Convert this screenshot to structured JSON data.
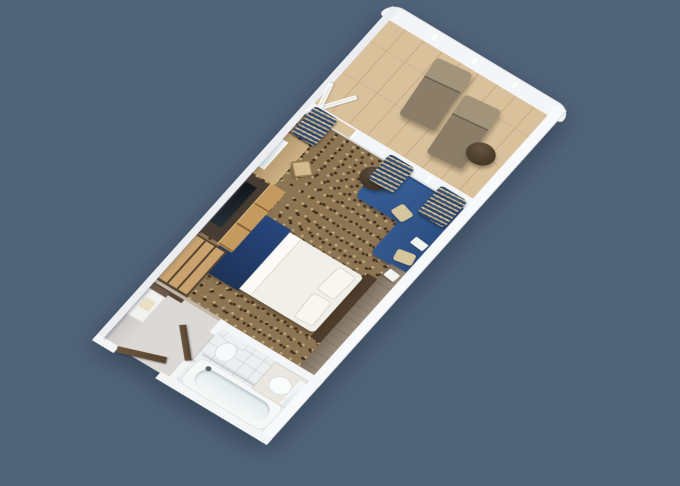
{
  "scene": {
    "type": "3d-floorplan-render",
    "title": "Cruise ship balcony stateroom - 3D floor plan",
    "view": "rotated top-down axonometric"
  },
  "theme": {
    "bg": "#51647a",
    "wall": "#f4f5f7",
    "carpet": "#8d7553",
    "balconyfloor": "#d9c19c",
    "hallfloor": "#dbd8d5",
    "bathfloor": "#eceff0",
    "glass": "#f2f6f8",
    "sofa": "#31598e",
    "cream": "#d6c69e"
  },
  "rooms": [
    {
      "name": "Balcony",
      "floor": "light wood planks",
      "furniture": [
        {
          "label": "Chaise lounge chair"
        },
        {
          "label": "Chaise lounge chair"
        },
        {
          "label": "Round outdoor table"
        },
        {
          "label": "Glass balustrade"
        },
        {
          "label": "Open sliding glass door"
        }
      ]
    },
    {
      "name": "Stateroom",
      "floor": "patterned brown carpet",
      "furniture": [
        {
          "label": "Bed with white duvet and navy runner"
        },
        {
          "label": "L-shaped navy sofa"
        },
        {
          "label": "Round coffee table"
        },
        {
          "label": "Wood ledge desk"
        },
        {
          "label": "Vanity desk with mirror"
        },
        {
          "label": "Desk chair"
        },
        {
          "label": "Flat-screen TV"
        },
        {
          "label": "TV console cabinet"
        },
        {
          "label": "Wardrobe closet"
        },
        {
          "label": "Navy and tan curtains"
        },
        {
          "label": "Dark wood headboard"
        },
        {
          "label": "Floor-to-ceiling windows"
        }
      ]
    },
    {
      "name": "Entry hall",
      "floor": "light vinyl",
      "furniture": [
        {
          "label": "Cabin entry door"
        },
        {
          "label": "Storage niche"
        },
        {
          "label": "Bathroom door"
        }
      ]
    },
    {
      "name": "Bathroom",
      "floor": "white tile",
      "furniture": [
        {
          "label": "Bathtub with shower"
        },
        {
          "label": "Vanity sink"
        },
        {
          "label": "Bathroom mirror"
        },
        {
          "label": "Toilet"
        }
      ]
    }
  ]
}
